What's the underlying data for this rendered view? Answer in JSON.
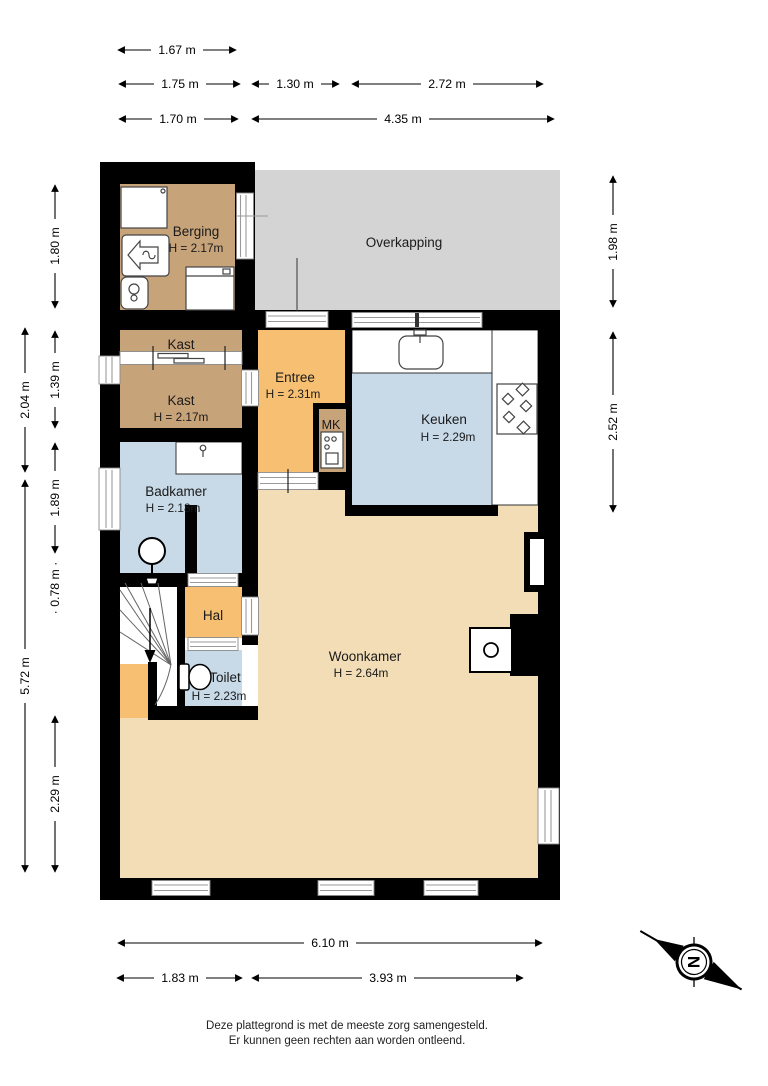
{
  "rooms": {
    "berging": {
      "name": "Berging",
      "height": "H = 2.17m"
    },
    "overkapping": {
      "name": "Overkapping"
    },
    "kast_boven": {
      "name": "Kast"
    },
    "kast": {
      "name": "Kast",
      "height": "H = 2.17m"
    },
    "entree": {
      "name": "Entree",
      "height": "H = 2.31m"
    },
    "mk": {
      "name": "MK"
    },
    "keuken": {
      "name": "Keuken",
      "height": "H = 2.29m"
    },
    "badkamer": {
      "name": "Badkamer",
      "height": "H = 2.18m"
    },
    "hal": {
      "name": "Hal"
    },
    "toilet": {
      "name": "Toilet",
      "height": "H = 2.23m"
    },
    "woonkamer": {
      "name": "Woonkamer",
      "height": "H = 2.64m"
    }
  },
  "dimensions": {
    "top": {
      "d1": "1.67 m",
      "d2": "1.75 m",
      "d3": "1.30 m",
      "d4": "2.72 m",
      "d5": "1.70 m",
      "d6": "4.35 m"
    },
    "left": {
      "d1": "1.80 m",
      "d2": "2.04 m",
      "d3": "1.39 m",
      "d4": "1.89 m",
      "d5": "· 0.78 m ·",
      "d6": "5.72 m",
      "d7": "2.29 m"
    },
    "right": {
      "d1": "1.98 m",
      "d2": "2.52 m"
    },
    "bottom": {
      "d1": "6.10 m",
      "d2": "1.83 m",
      "d3": "3.93 m"
    }
  },
  "compass": {
    "label": "N"
  },
  "footer": {
    "line1": "Deze plattegrond is met de meeste zorg samengesteld.",
    "line2": "Er kunnen geen rechten aan worden ontleend."
  },
  "colors": {
    "wall": "#000000",
    "wood": "#c7a37a",
    "orange": "#f6bf72",
    "blue": "#c8d9e8",
    "beige": "#f2ddb6",
    "overkapping": "#d4d4d4",
    "door_line": "#9a9a9a"
  }
}
